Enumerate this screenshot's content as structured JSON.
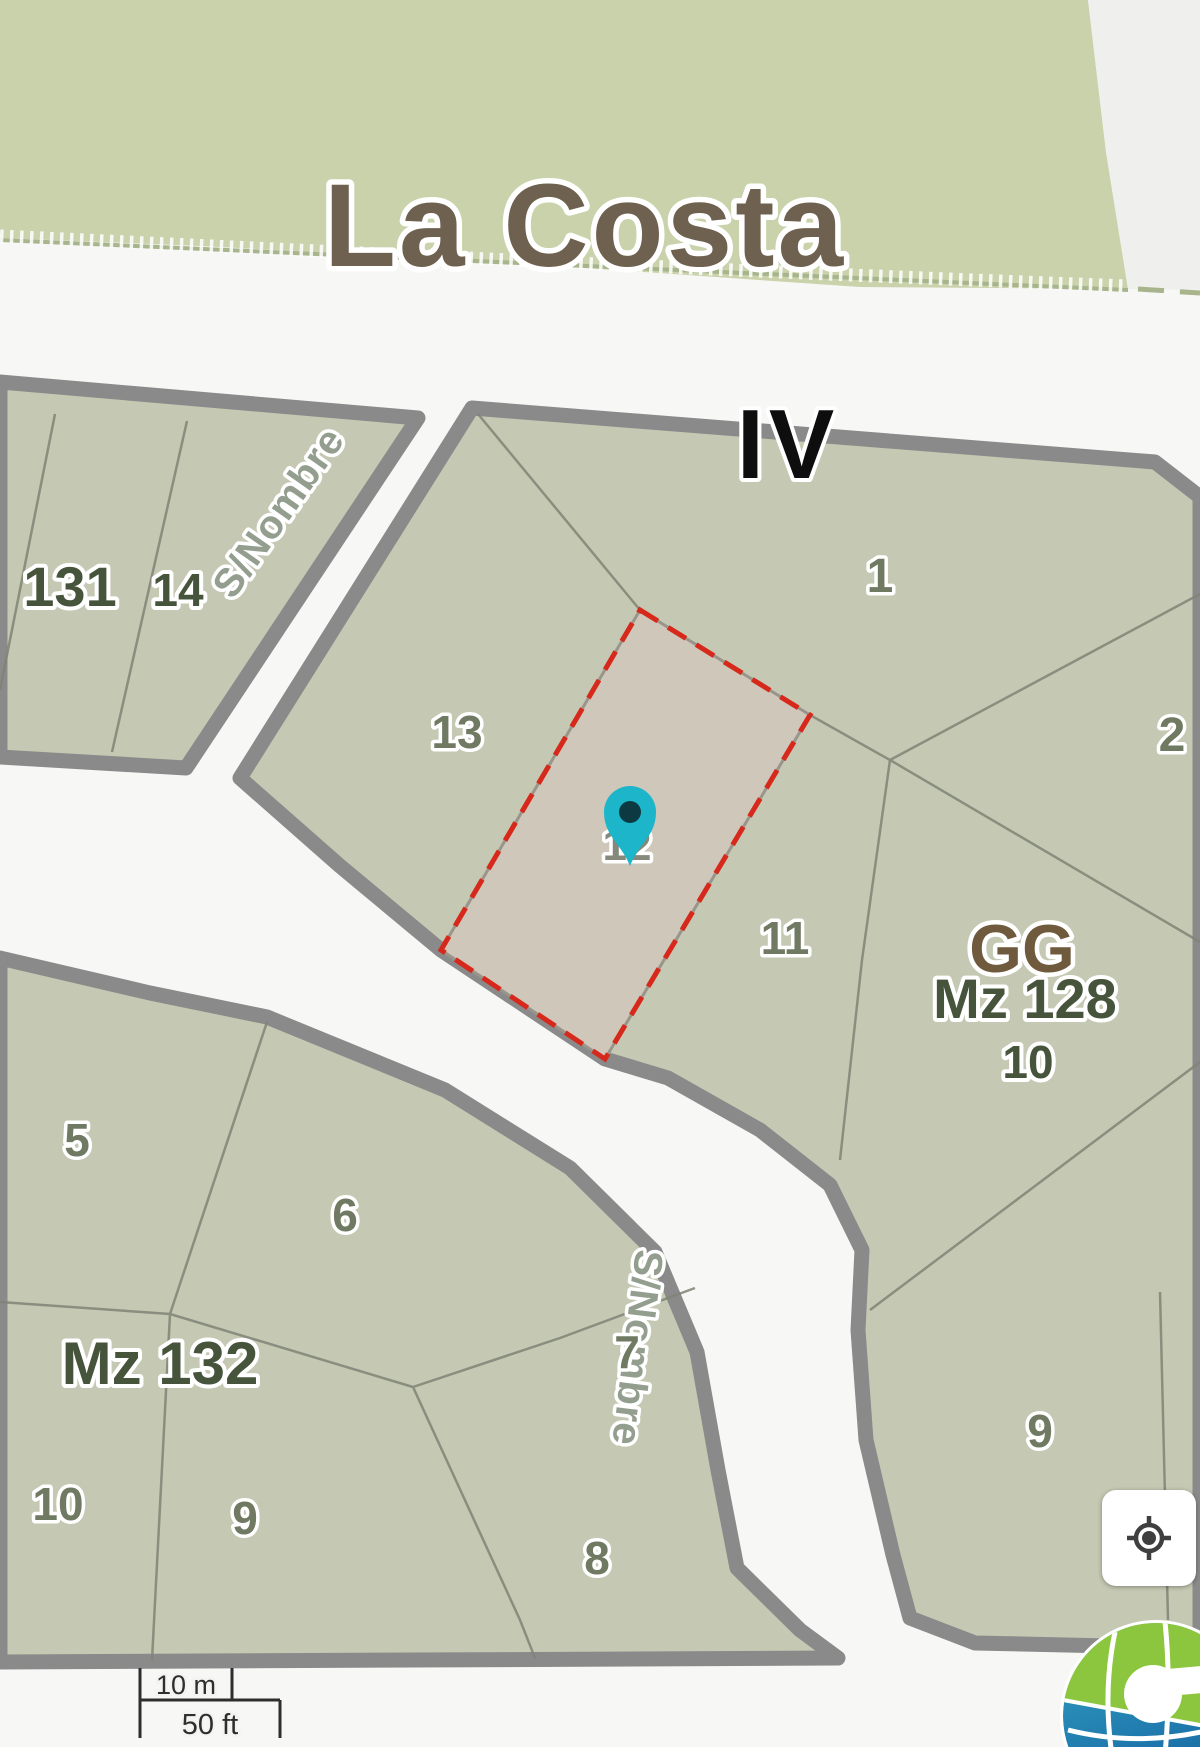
{
  "map": {
    "locality_label": "La Costa",
    "sector_label": "IV",
    "street_labels": [
      {
        "text": "S/Nombre"
      },
      {
        "text": "S/Nombre"
      }
    ],
    "block_labels": [
      {
        "text": "131"
      },
      {
        "text": "14"
      },
      {
        "text": "GG"
      },
      {
        "text": "Mz 128"
      },
      {
        "text": "10"
      },
      {
        "text": "Mz 132"
      }
    ],
    "parcel_labels": [
      {
        "text": "1"
      },
      {
        "text": "2"
      },
      {
        "text": "13"
      },
      {
        "text": "12"
      },
      {
        "text": "11"
      },
      {
        "text": "5"
      },
      {
        "text": "6"
      },
      {
        "text": "7"
      },
      {
        "text": "8"
      },
      {
        "text": "9"
      },
      {
        "text": "10"
      },
      {
        "text": "9"
      }
    ],
    "highlighted_parcel": {
      "number": "12",
      "border_color": "#d6291b",
      "fill_color": "#cfc7b9"
    },
    "marker": {
      "color": "#1cb5c9",
      "dot_color": "#0d3a42"
    },
    "colors": {
      "locality_fill": "#c9d2ab",
      "block_fill": "#c5c9b3",
      "road_fill": "#f7f7f5",
      "road_casing": "#8a8a8a",
      "parcel_line": "#7f8476"
    }
  },
  "controls": {
    "locate_button": {
      "icon": "gps-target",
      "color": "#3f3f3f"
    }
  },
  "scale_bar": {
    "metric": "10 m",
    "imperial": "50 ft"
  },
  "branding": {
    "logo": "globe-c-logo",
    "green": "#8cc63f",
    "blue_top": "#36a7c4",
    "blue_bottom": "#1565a3"
  }
}
